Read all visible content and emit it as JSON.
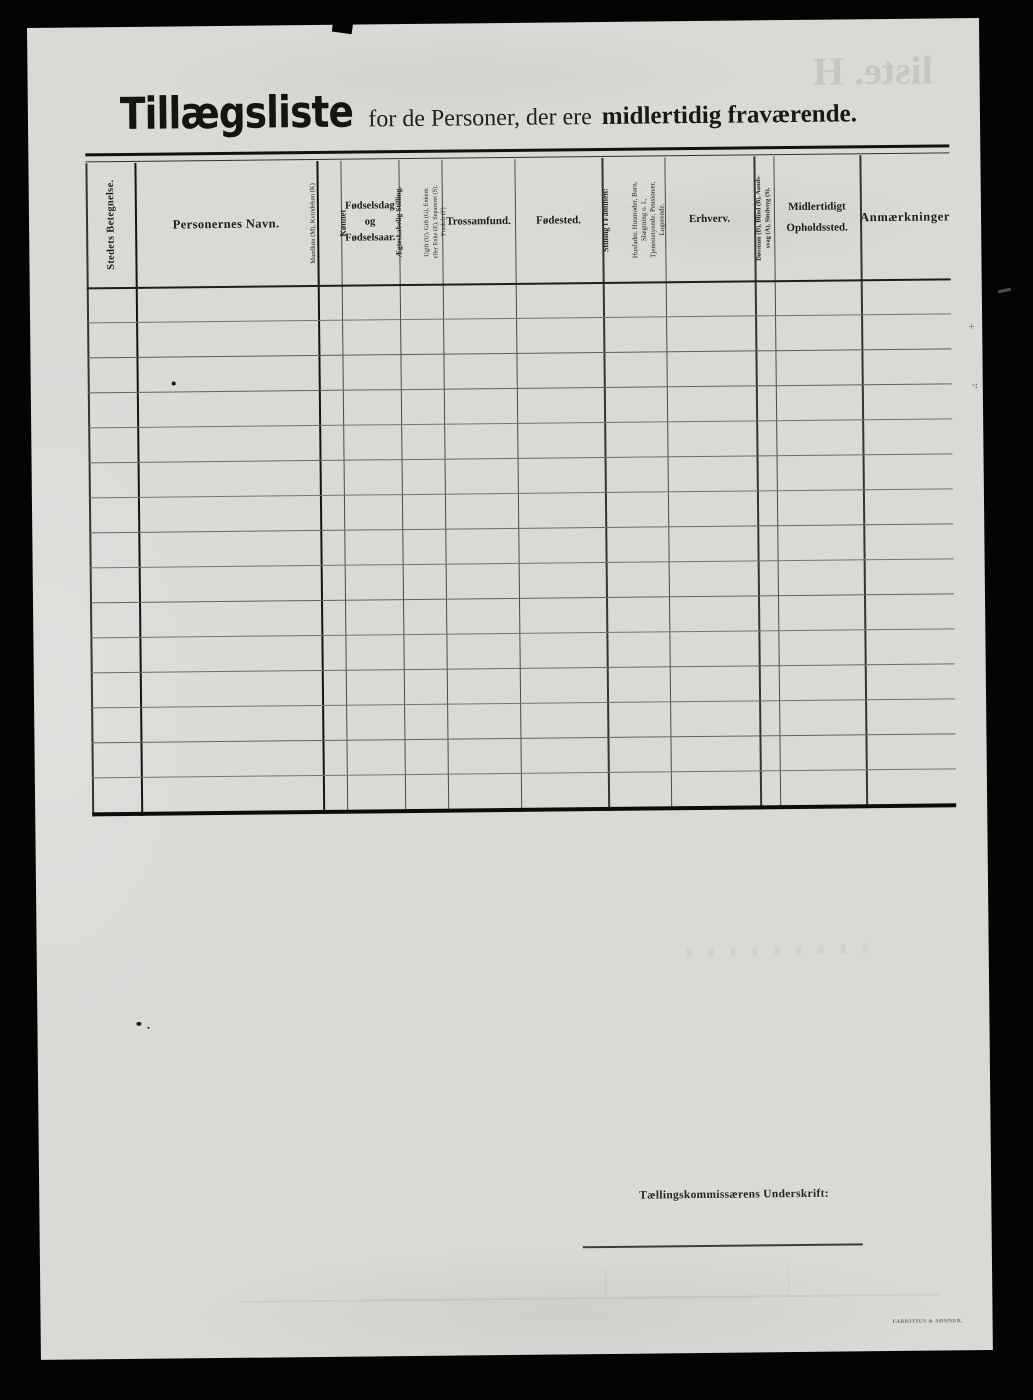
{
  "document": {
    "title": "Tillægsliste",
    "subtitle_regular": "for de Personer, der ere",
    "subtitle_bold": "midlertidig fraværende."
  },
  "table": {
    "headers": {
      "stedets_betegnelse": "Stedets Betegnelse.",
      "personernes_navn": "Personernes Navn.",
      "konnet_main": "Kønnet",
      "konnet_sub": "Mandkøn (M), Kvindekøn (K)",
      "fodselsdag": "Fødselsdag\nog\nFødselsaar.",
      "aegteskabelig_main": "Ægteskabelig Stilling.",
      "aegteskabelig_sub": "Ugift (U), Gift (G), Enkem.\neller Enke (E), Separeret (S),\nFraskilt (F)",
      "trossamfund": "Trossamfund.",
      "fodested": "Fødested.",
      "stilling_main": "Stilling i Familien:",
      "stilling_sub": "Husfader, Husmoder, Barn,\nSlægtning o. l.,\nTjenestetyende, Pensionær,\nLogerende.",
      "erhverv": "Erhverv.",
      "dovstum": "Døvstum (D), Blind (B), Aands-\nsvag (A), Sindssyg (S).",
      "midlertidigt": "Midlertidigt\nOpholdssted.",
      "anmaerkninger": "Anmærkninger"
    },
    "body_rows_empty": 15
  },
  "footer": {
    "signature_label": "Tællingskommissærens Underskrift:",
    "printer_mark": "FABRITIUS & SØNNER."
  },
  "artifacts": {
    "bleedthrough_text": "liste. H"
  },
  "colors": {
    "frame": "#040404",
    "paper": "#d9d9d6",
    "ink": "#1b1b18",
    "rule_dark": "#141412",
    "rule_light": "#76766f"
  }
}
